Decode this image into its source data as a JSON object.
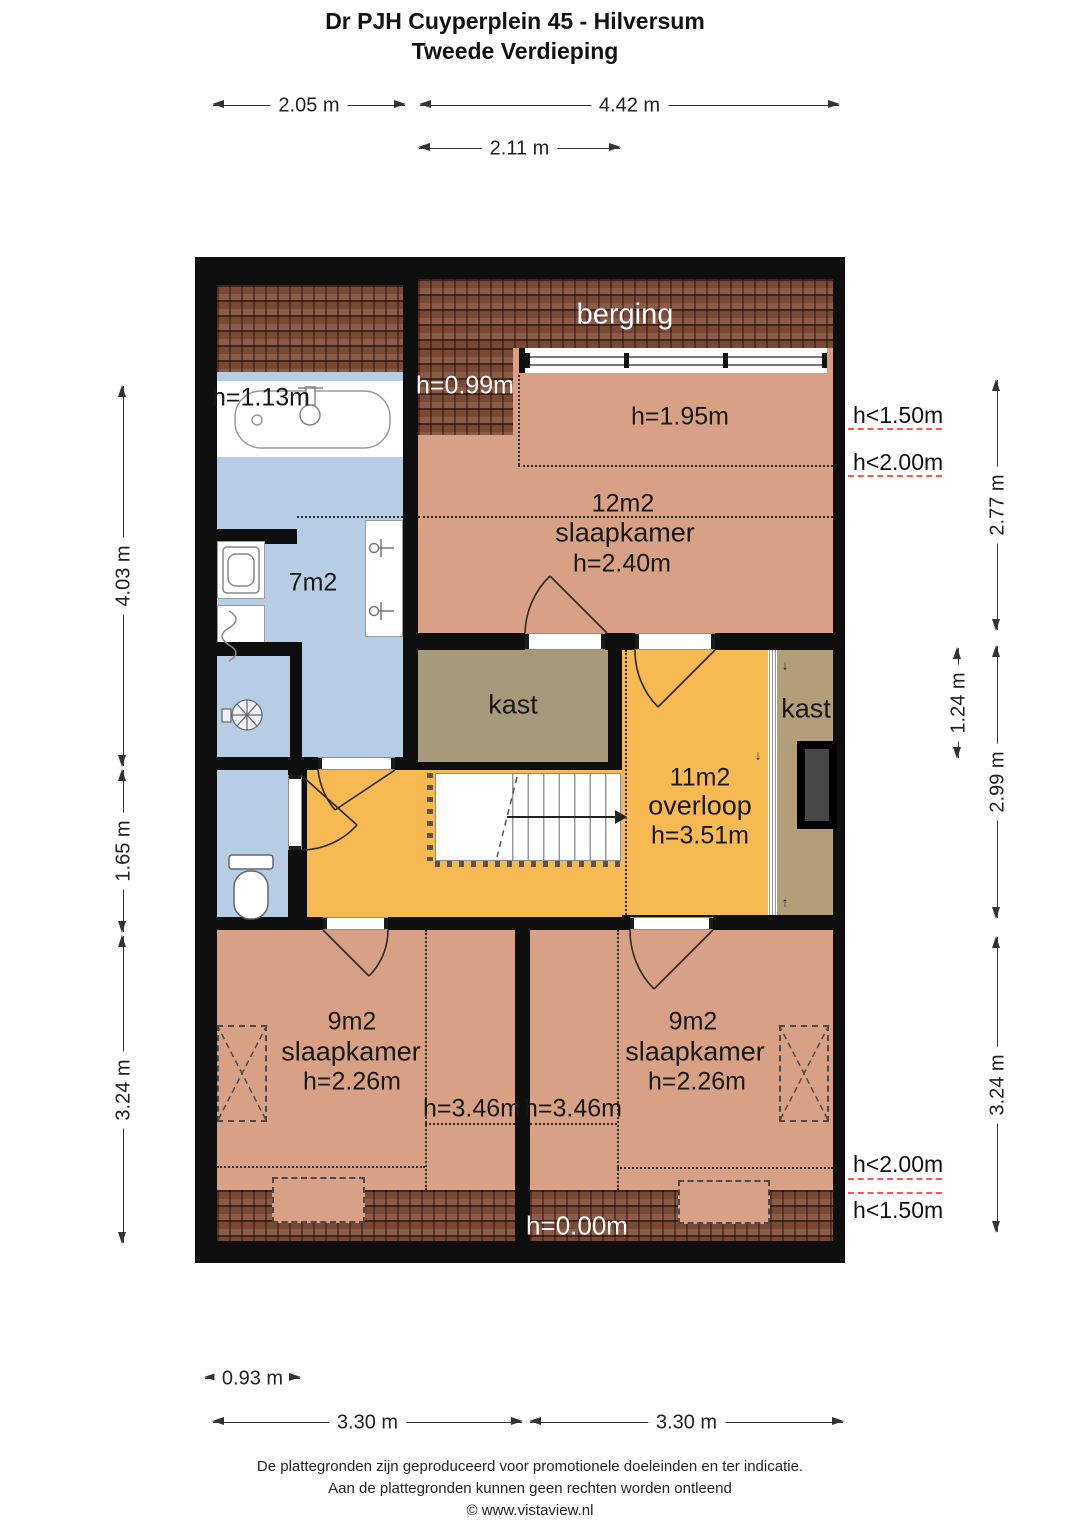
{
  "title": {
    "line1": "Dr PJH Cuyperplein 45 - Hilversum",
    "line2": "Tweede Verdieping"
  },
  "dimensions": {
    "top": [
      "2.05 m",
      "4.42 m",
      "2.11 m"
    ],
    "left": [
      "4.03 m",
      "1.65 m",
      "3.24 m"
    ],
    "right": [
      "2.77 m",
      "1.24 m",
      "2.99 m",
      "3.24 m"
    ],
    "bottom": [
      "0.93 m",
      "3.30 m",
      "3.30 m"
    ]
  },
  "rooms": {
    "berging": {
      "name": "berging"
    },
    "bedroom_large": {
      "area": "12m2",
      "name": "slaapkamer",
      "height": "h=2.40m"
    },
    "bathroom": {
      "area": "7m2"
    },
    "closet_left": {
      "name": "kast"
    },
    "closet_right": {
      "name": "kast"
    },
    "landing": {
      "area": "11m2",
      "name": "overloop",
      "height": "h=3.51m"
    },
    "bedroom_left": {
      "area": "9m2",
      "name": "slaapkamer",
      "height": "h=2.26m"
    },
    "bedroom_right": {
      "area": "9m2",
      "name": "slaapkamer",
      "height": "h=2.26m"
    }
  },
  "annotations": {
    "tub_height": "h=1.13m",
    "roof_patch_height": "h=0.99m",
    "zone_height": "h=1.95m",
    "right_top_1": "h<1.50m",
    "right_top_2": "h<2.00m",
    "left_bed_line": "h=3.46m",
    "right_bed_line": "h=3.46m",
    "roof_zero": "h=0.00m",
    "right_bottom_1": "h<2.00m",
    "right_bottom_2": "h<1.50m",
    "arrow_down": "↓",
    "arrow_up": "↑"
  },
  "footer": {
    "line1": "De plattegronden zijn geproduceerd voor promotionele doeleinden en ter indicatie.",
    "line2": "Aan de plattegronden kunnen geen rechten worden ontleend",
    "line3": "© www.vistaview.nl"
  },
  "colors": {
    "wall": "#0e0e0e",
    "floor_salmon": "#d8a185",
    "floor_blue": "#b7cde6",
    "floor_orange": "#f7b952",
    "closet_khaki": "#a69a7b",
    "closet_khaki_right": "#b29e79",
    "roof_brown": "#7a4936",
    "red_dash": "#ff564d"
  }
}
